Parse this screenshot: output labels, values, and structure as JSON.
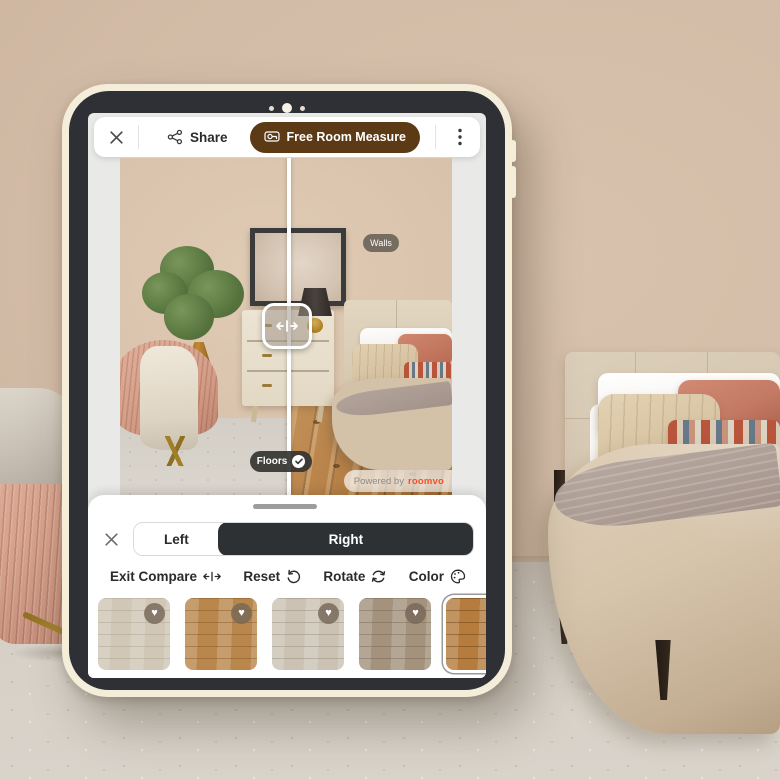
{
  "tablet": {
    "topbar": {
      "share": "Share",
      "measure": "Free Room Measure"
    },
    "photo_overlays": {
      "walls": "Walls",
      "floors": "Floors",
      "powered_by": "Powered by",
      "brand": "roomvo"
    },
    "sheet": {
      "tabs": {
        "left": "Left",
        "right": "Right",
        "active": "Right"
      },
      "toolbar": {
        "exit_compare": "Exit Compare",
        "reset": "Reset",
        "rotate": "Rotate",
        "color": "Color"
      },
      "swatches": [
        {
          "name": "light-cream-oak",
          "base": "#d0c7b6",
          "grain": "rgba(158,147,126,0.35)",
          "favorited": true,
          "selected": false
        },
        {
          "name": "honey-oak",
          "base": "#b9874c",
          "grain": "rgba(122,72,26,0.38)",
          "favorited": true,
          "selected": false
        },
        {
          "name": "washed-gray-oak",
          "base": "#cbc2b3",
          "grain": "rgba(138,128,112,0.38)",
          "favorited": true,
          "selected": false
        },
        {
          "name": "taupe-oak",
          "base": "#a4927c",
          "grain": "rgba(108,93,74,0.38)",
          "favorited": true,
          "selected": false
        },
        {
          "name": "natural-knotty-oak",
          "base": "#b57c3e",
          "grain": "rgba(98,58,18,0.45)",
          "favorited": false,
          "selected": true
        }
      ]
    },
    "colors": {
      "accent_brown": "#5d3a16",
      "brand_orange": "#f4502c",
      "active_segment": "#2e3134",
      "walls_pill": "#686156",
      "floors_pill": "#343432"
    }
  },
  "scene_colors": {
    "wall": "#d2bba6",
    "carpet": "#d6d0c7",
    "headboard": "#d5c7b1",
    "duvet": "#d6c4ab",
    "accent_pillow": "#c37a64",
    "chair": "#d8a28c"
  }
}
